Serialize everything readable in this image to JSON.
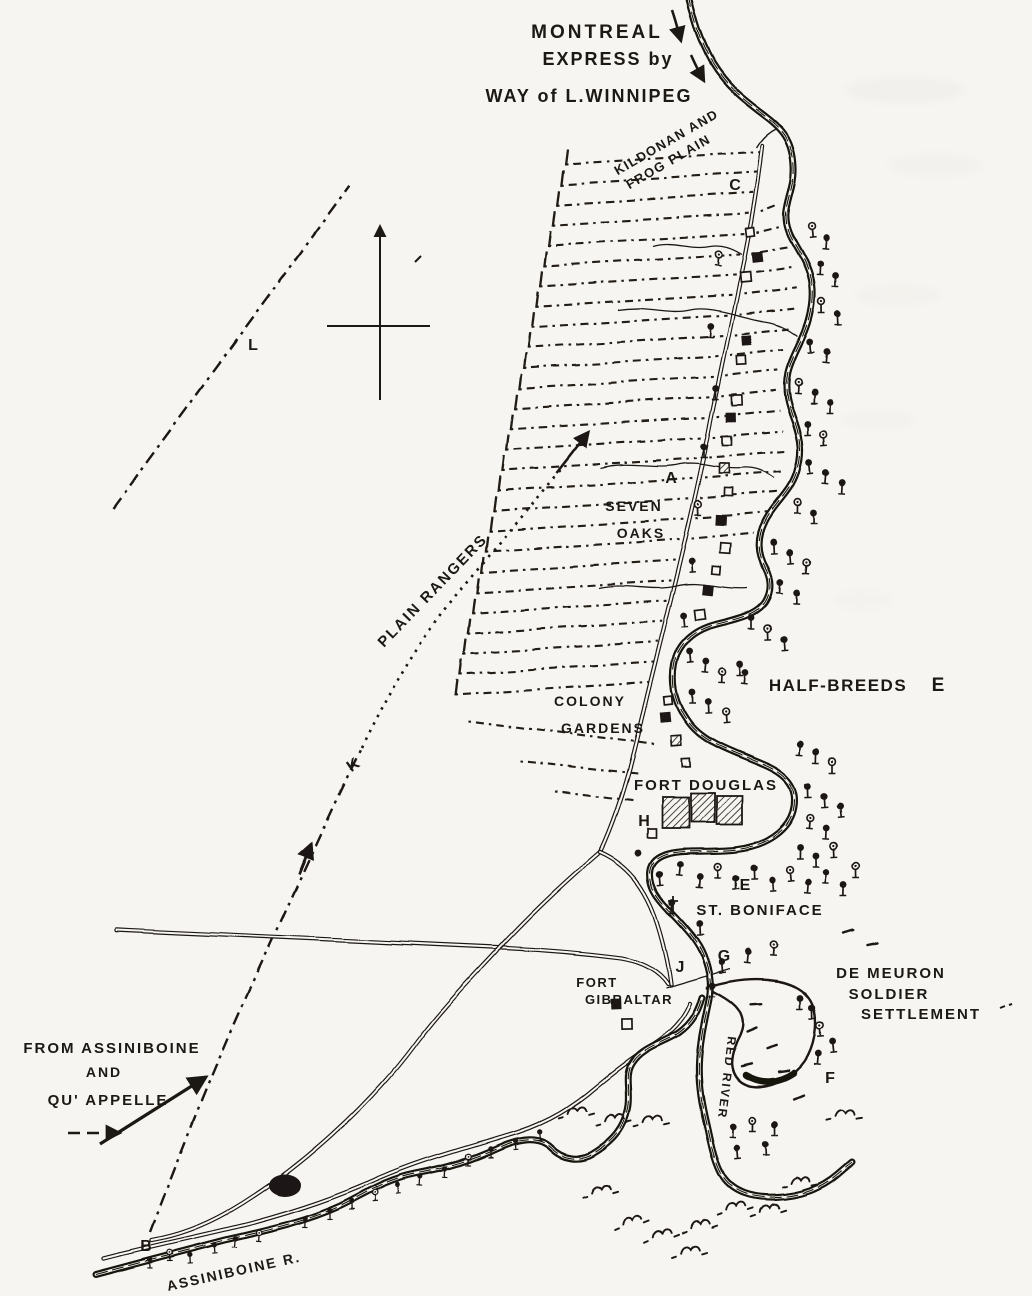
{
  "map": {
    "labels": {
      "montreal_1": "MONTREAL",
      "montreal_2": "EXPRESS by",
      "montreal_3": "WAY of L.WINNIPEG",
      "kildonan_1": "KILDONAN AND",
      "kildonan_2": "FROG PLAIN",
      "seven_oaks_1": "SEVEN",
      "seven_oaks_2": "OAKS",
      "plain_rangers": "PLAIN RANGERS",
      "half_breeds": "HALF-BREEDS",
      "colony_1": "COLONY",
      "colony_2": "GARDENS",
      "fort_douglas": "FORT DOUGLAS",
      "st_boniface": "ST. BONIFACE",
      "fort_gibraltar_1": "FORT",
      "fort_gibraltar_2": "GIBRALTAR",
      "de_meuron_1": "DE MEURON",
      "de_meuron_2": "SOLDIER",
      "de_meuron_3": "SETTLEMENT",
      "from_assiniboine_1": "FROM ASSINIBOINE",
      "from_assiniboine_2": "AND",
      "from_assiniboine_3": "QU' APPELLE",
      "red_river": "RED RIVER",
      "assiniboine_river": "ASSINIBOINE R."
    },
    "markers": {
      "a": "A",
      "b": "B",
      "c": "C",
      "e_half_breeds": "E",
      "e_st_boniface": "E",
      "f": "F",
      "g": "G",
      "h": "H",
      "j": "J",
      "k": "K",
      "l": "L"
    },
    "colors": {
      "ink": "#1c1813",
      "paper": "#f6f5f1"
    }
  }
}
